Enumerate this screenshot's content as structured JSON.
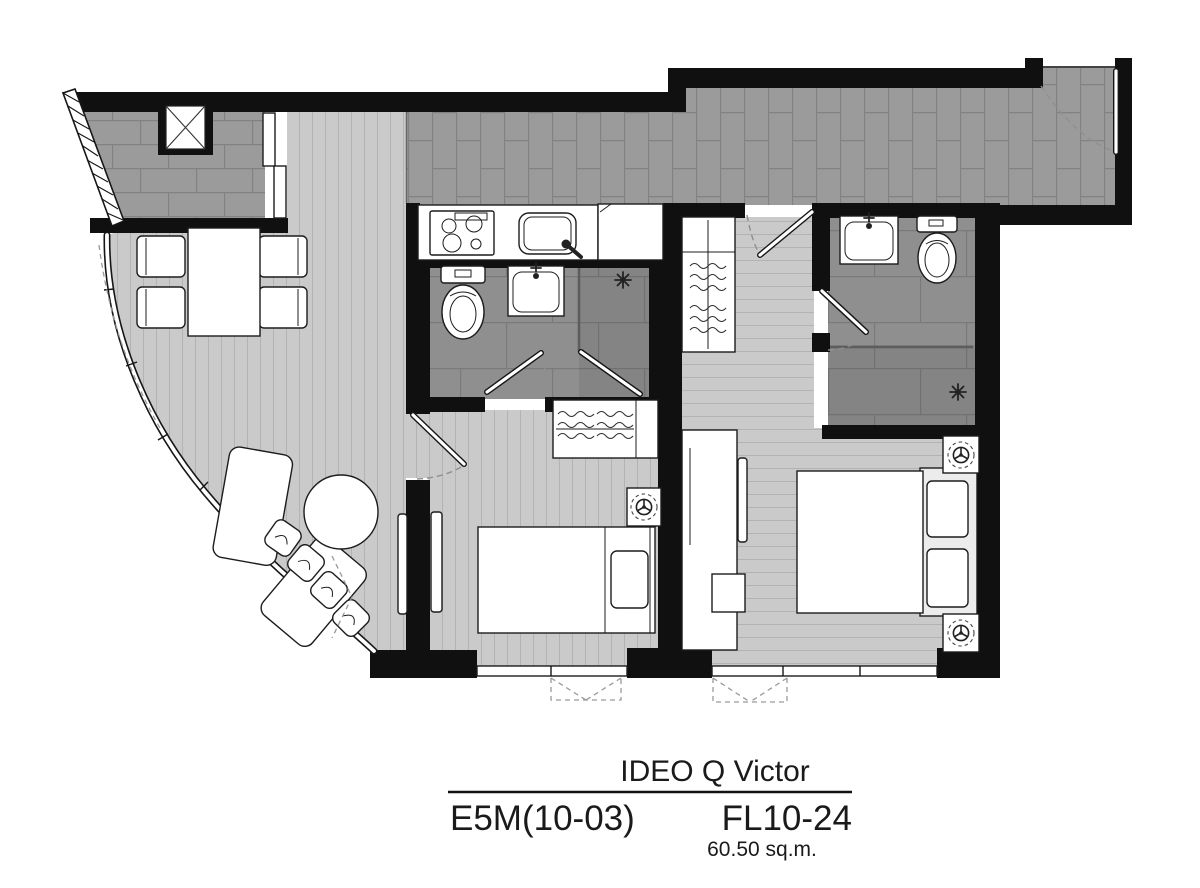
{
  "title_block": {
    "project_name": "IDEO Q Victor",
    "unit_type": "E5M(10-03)",
    "floor_range": "FL10-24",
    "unit_area": "60.50 sq.m."
  },
  "icons": {
    "ac_unit": "crossed-box",
    "ceiling_fan": "three-blade-fan-in-dashed-circle",
    "shower_head": "asterisk-spray",
    "window_opening": "dashed-trapezoid",
    "door_swing": "dashed-arc"
  },
  "colors": {
    "wall": "#101010",
    "tile_floor": "#9b9b9b",
    "tile_grout": "#828282",
    "bath_tile": "#8f8f8f",
    "bath_grout": "#7a7a7a",
    "plank_floor": "#cacaca",
    "plank_line": "#b3b3b3",
    "furniture_fill": "#ffffff",
    "furniture_stroke": "#1c1c1c",
    "text_color": "#1a1a1a",
    "background": "#ffffff"
  }
}
